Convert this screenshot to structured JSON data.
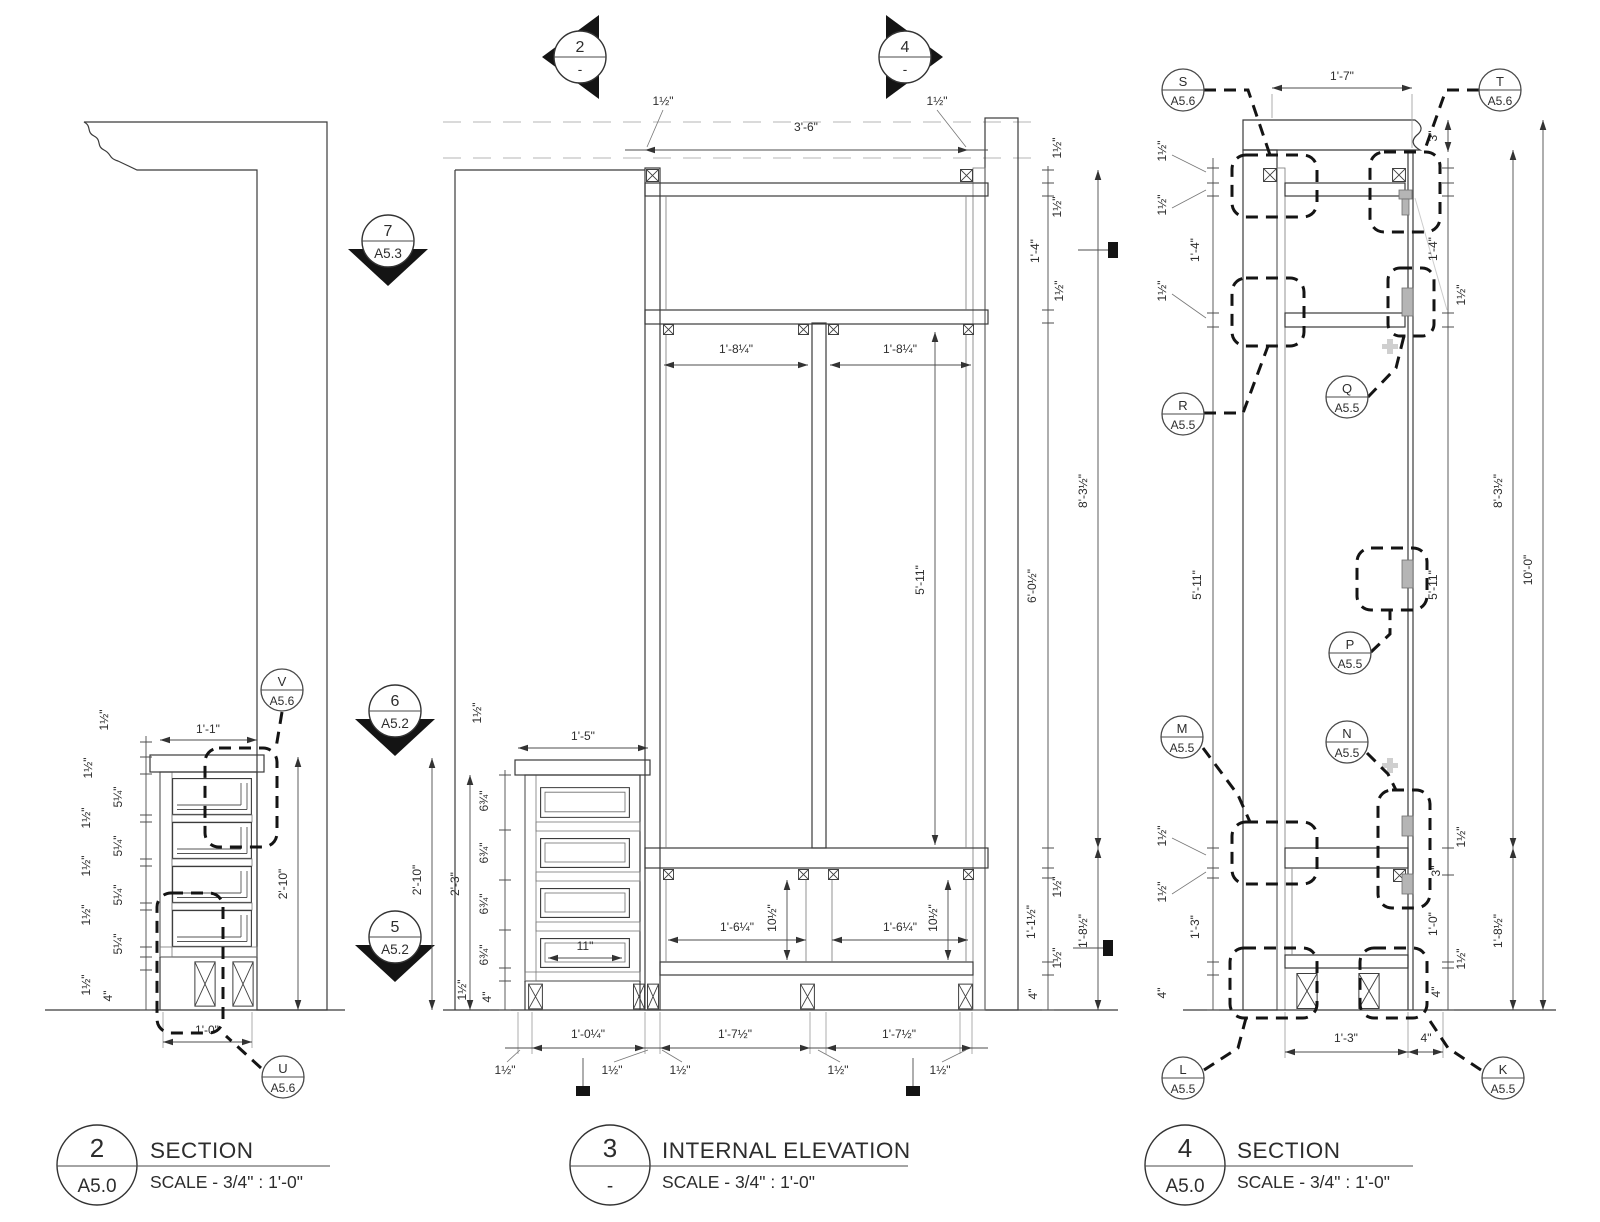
{
  "document": {
    "type": "millwork shop drawing sheet",
    "background": "#ffffff",
    "line_color": "#3b3b3b",
    "accent_black": "#141414"
  },
  "dims": {
    "half_inch": "1½\"",
    "five_quarter": "5¼\"",
    "six_three_quarter": "6¾\"",
    "four_inch": "4\"",
    "three_inch": "3\"",
    "eleven_inch": "11\"",
    "ten_half_inch": "10½\"",
    "ft1_0": "1'-0\"",
    "ft1_0_quarter": "1'-0¼\"",
    "ft1_1": "1'-1\"",
    "ft1_1_half": "1'-1½\"",
    "ft1_3": "1'-3\"",
    "ft1_4": "1'-4\"",
    "ft1_5": "1'-5\"",
    "ft1_6_quarter": "1'-6¼\"",
    "ft1_7": "1'-7\"",
    "ft1_7_half": "1'-7½\"",
    "ft1_8_quarter": "1'-8¼\"",
    "ft1_8_half": "1'-8½\"",
    "ft2_3": "2'-3\"",
    "ft2_10": "2'-10\"",
    "ft3_6": "3'-6\"",
    "ft5_11": "5'-11\"",
    "ft6_0_half": "6'-0½\"",
    "ft8_3_half": "8'-3½\"",
    "ft10_0": "10'-0\""
  },
  "markers": {
    "sec2": {
      "number": "2",
      "sheet": "-"
    },
    "sec4": {
      "number": "4",
      "sheet": "-"
    },
    "sec7": {
      "number": "7",
      "sheet": "A5.3"
    },
    "sec6": {
      "number": "6",
      "sheet": "A5.2"
    },
    "sec5": {
      "number": "5",
      "sheet": "A5.2"
    }
  },
  "bubbles": {
    "V": {
      "letter": "V",
      "sheet": "A5.6"
    },
    "U": {
      "letter": "U",
      "sheet": "A5.6"
    },
    "S": {
      "letter": "S",
      "sheet": "A5.6"
    },
    "T": {
      "letter": "T",
      "sheet": "A5.6"
    },
    "R": {
      "letter": "R",
      "sheet": "A5.5"
    },
    "Q": {
      "letter": "Q",
      "sheet": "A5.5"
    },
    "P": {
      "letter": "P",
      "sheet": "A5.5"
    },
    "M": {
      "letter": "M",
      "sheet": "A5.5"
    },
    "N": {
      "letter": "N",
      "sheet": "A5.5"
    },
    "L": {
      "letter": "L",
      "sheet": "A5.5"
    },
    "K": {
      "letter": "K",
      "sheet": "A5.5"
    }
  },
  "title_blocks": [
    {
      "number": "2",
      "sheet": "A5.0",
      "title": "SECTION",
      "scale": "SCALE - 3/4\" : 1'-0\""
    },
    {
      "number": "3",
      "sheet": "-",
      "title": "INTERNAL ELEVATION",
      "scale": "SCALE - 3/4\" : 1'-0\""
    },
    {
      "number": "4",
      "sheet": "A5.0",
      "title": "SECTION",
      "scale": "SCALE - 3/4\" : 1'-0\""
    }
  ]
}
